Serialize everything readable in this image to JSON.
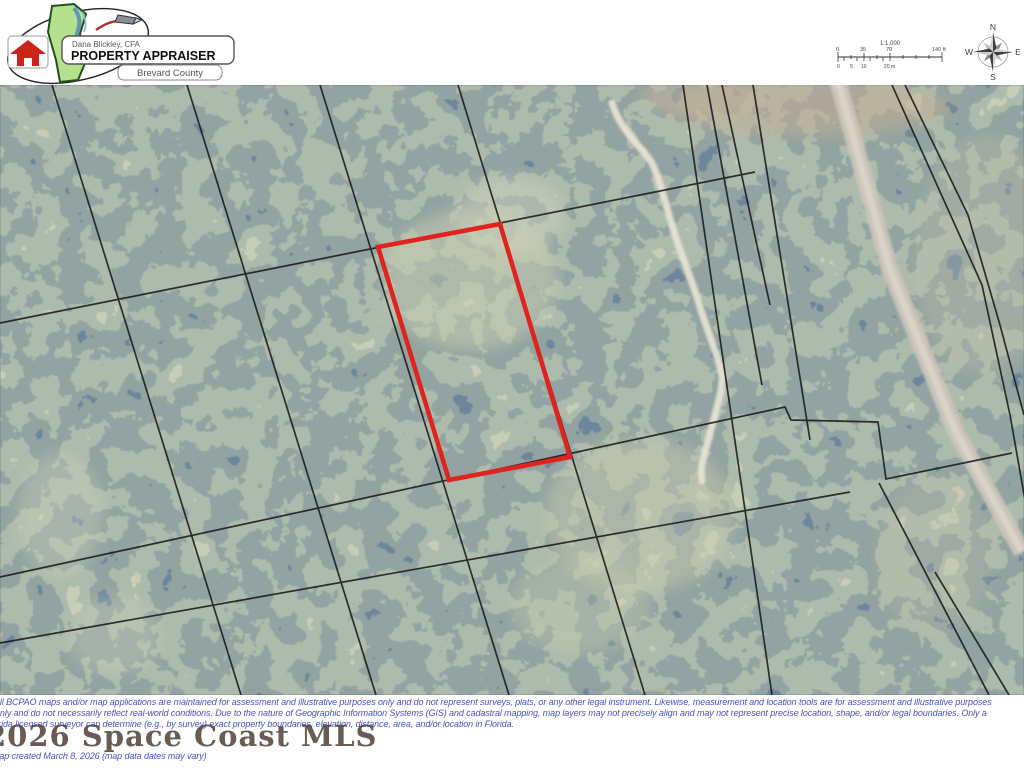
{
  "header": {
    "logo": {
      "appraiser_name": "Dana Blickley, CFA",
      "office": "PROPERTY APPRAISER",
      "county": "Brevard County"
    },
    "scale_bar": {
      "ratio": "1:1,000",
      "ft_ticks": [
        "0",
        "35",
        "70",
        "140 ft"
      ],
      "m_ticks": [
        "0",
        "5",
        "10",
        "20 m"
      ]
    },
    "compass": {
      "north": "N",
      "south": "S",
      "east": "E",
      "west": "W"
    }
  },
  "map": {
    "subject_parcel_color": "#e0231c",
    "boundary_line_color": "#1a1a1a",
    "road_color": "#cbc5b9",
    "road_center_color": "#dcd6ca",
    "trail_color": "#eae5d4"
  },
  "footer": {
    "disclaimer_color": "#4553c0",
    "watermark_color": "#473930",
    "line1": "All BCPAO maps and/or map applications are maintained for assessment and illustrative purposes only and do not represent surveys, plats, or any other legal instrument. Likewise, measurement and location tools are for assessment and illustrative purposes",
    "line2": "only and do not necessarily reflect real-world conditions. Due to the nature of Geographic Information Systems (GIS) and cadastral mapping, map layers may not precisely align and may not represent precise location, shape, and/or legal boundaries. Only a",
    "line3": "Florida licensed surveyor can determine (e.g., by survey) exact property boundaries, elevation, distance, area, and/or location in Florida.",
    "watermark": "2026 Space Coast MLS",
    "created": "Map created March 8, 2026 (map data dates may vary)"
  }
}
